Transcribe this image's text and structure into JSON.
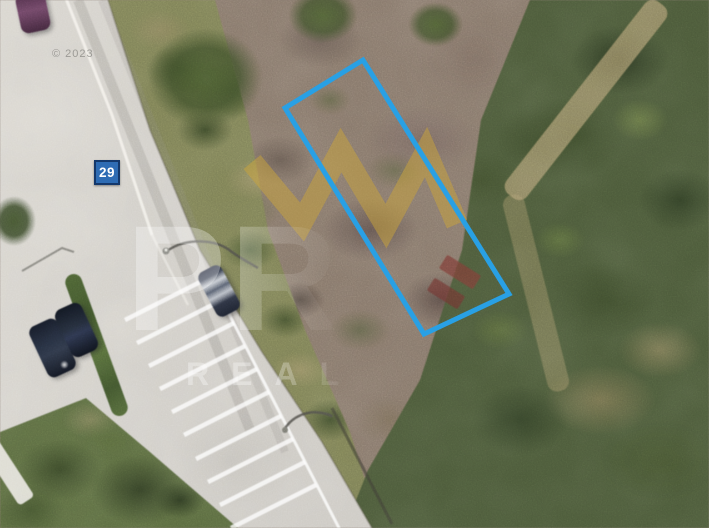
{
  "map": {
    "type": "satellite-imagery",
    "route_badge": {
      "label": "29",
      "bg_color": "#2e6cb4",
      "border_color": "#14386b",
      "text_color": "#ffffff"
    },
    "property_boundary": {
      "color": "#29a0e4"
    }
  },
  "watermark": {
    "logo_color": "#c9a43a",
    "big_text": "PR",
    "sub_text": "REAL",
    "faint_text": "© 2023",
    "text_color": "#ffffff"
  }
}
